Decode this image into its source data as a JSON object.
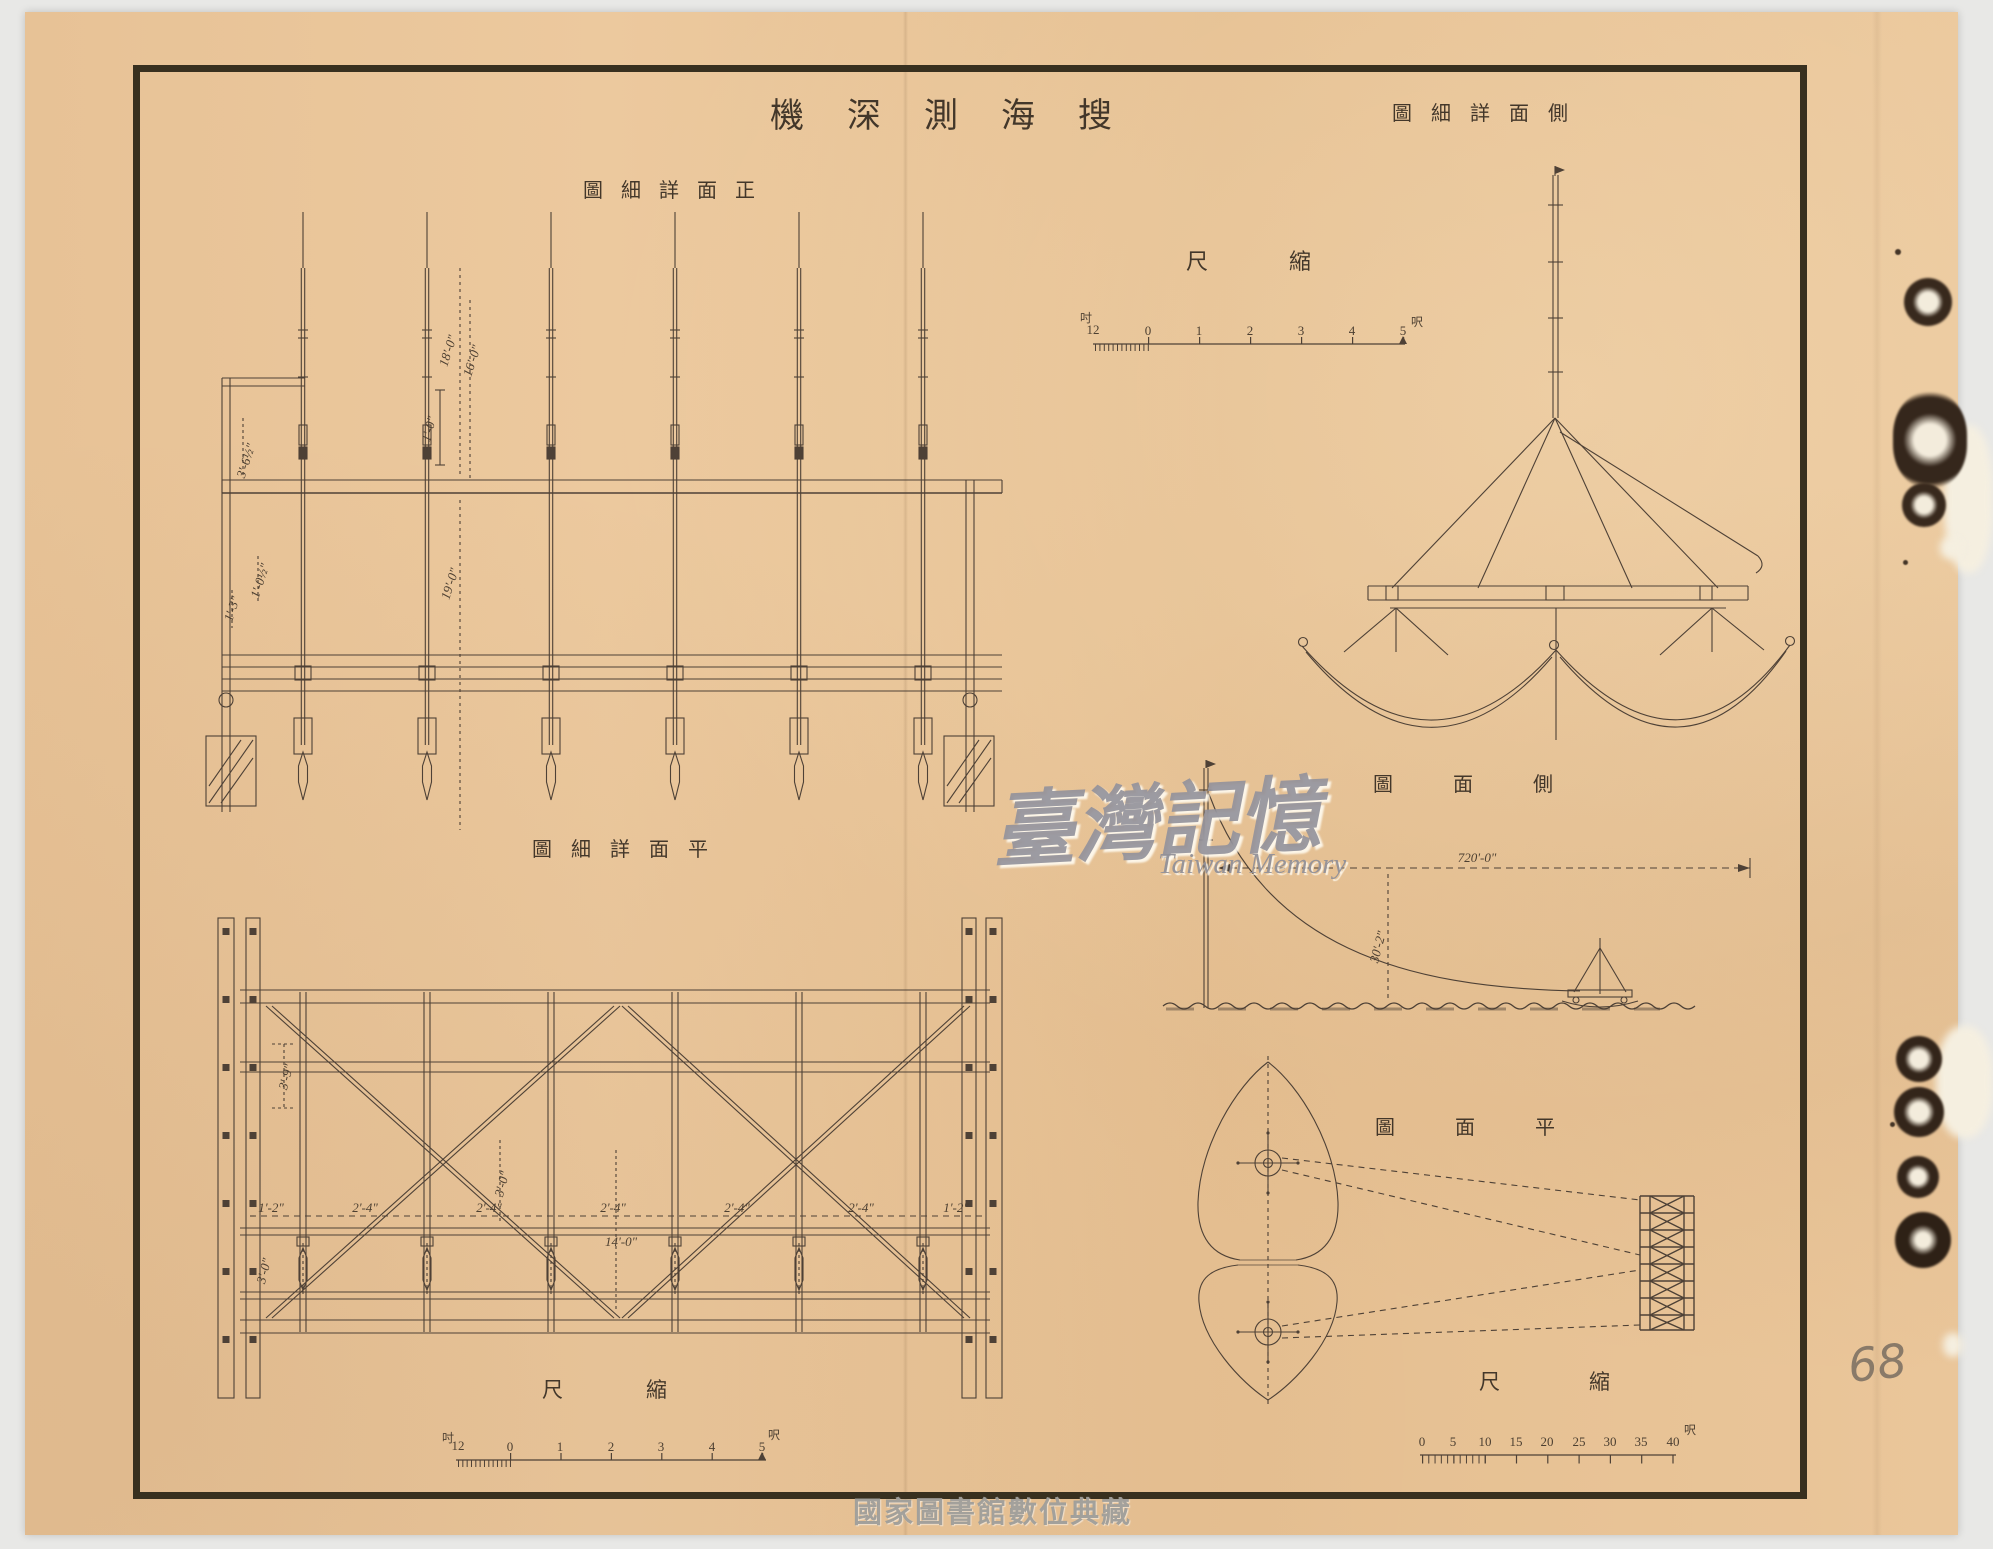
{
  "sheet": {
    "title": "機深測海搜"
  },
  "labels": {
    "front_detail": "圖細詳面正",
    "side_detail": "圖細詳面側",
    "plan_detail": "圖細詳面平",
    "side_view": "圖面側",
    "plan_view": "圖面平",
    "scale_front": "尺縮",
    "scale_plan": "尺縮",
    "scale_right": "尺縮"
  },
  "scale_bars": {
    "front": {
      "unit_minor": "吋",
      "unit_major": "呎",
      "ticks": [
        "12",
        "0",
        "1",
        "2",
        "3",
        "4",
        "5"
      ]
    },
    "plan": {
      "unit_minor": "吋",
      "unit_major": "呎",
      "ticks": [
        "12",
        "0",
        "1",
        "2",
        "3",
        "4",
        "5"
      ]
    },
    "right": {
      "unit_major": "呎",
      "ticks": [
        "0",
        "5",
        "10",
        "15",
        "20",
        "25",
        "30",
        "35",
        "40"
      ]
    }
  },
  "dimensions": {
    "front_elevation": {
      "mast_upper": "18'-0\"",
      "mast_inner": "16'-0\"",
      "offset": "1'-0\"",
      "mast_lower": "19'-0\"",
      "beam_height": "3'-6½\"",
      "spacing_a": "1'-0½\"",
      "spacing_b": "1'-3\""
    },
    "plan_detail": {
      "seg_end_l": "1'-2\"",
      "seg_1": "2'-4\"",
      "seg_2": "2'-4\"",
      "seg_3": "2'-4\"",
      "seg_4": "2'-4\"",
      "seg_5": "2'-4\"",
      "seg_end_r": "1'-2\"",
      "total": "14'-0\"",
      "width_a": "3'-9\"",
      "width_b": "3'-0\"",
      "width_c": "3'-0\""
    },
    "side_view": {
      "cable_length": "720'-0\"",
      "depth": "30'-2\""
    }
  },
  "watermarks": {
    "taiwan_memory_zh": "臺灣記憶",
    "taiwan_memory_en": "Taiwan Memory",
    "library": "國家圖書館數位典藏"
  },
  "annotations": {
    "handwritten_note": "68"
  }
}
